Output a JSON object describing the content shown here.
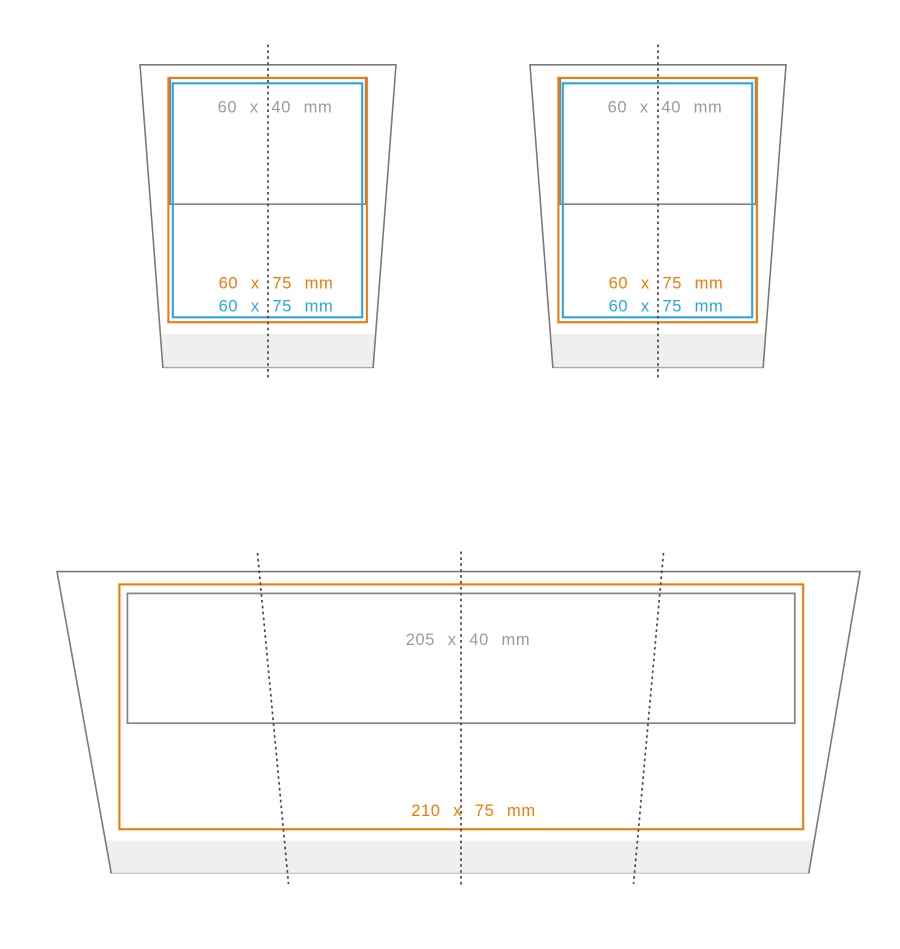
{
  "colors": {
    "orange": "#F1790A",
    "blue": "#27A7E2",
    "gray_text": "#9B9B9B",
    "gray_line": "#848484",
    "outline": "#7A7A7A",
    "dotted": "#474747",
    "band": "#EFEFEF",
    "band_edge_cup": "#A9A9A9",
    "band_edge_wrap": "#C9C9C9"
  },
  "figures": {
    "cup_left": {
      "labels": {
        "print_gray": "60 x 40 mm",
        "print_orange": "60 x 75 mm",
        "print_blue": "60 x 75 mm"
      }
    },
    "cup_right": {
      "labels": {
        "print_gray": "60 x 40 mm",
        "print_orange": "60 x 75 mm",
        "print_blue": "60 x 75 mm"
      }
    },
    "wrap": {
      "labels": {
        "print_gray": "205 x 40 mm",
        "print_orange": "210 x 75 mm"
      }
    }
  }
}
